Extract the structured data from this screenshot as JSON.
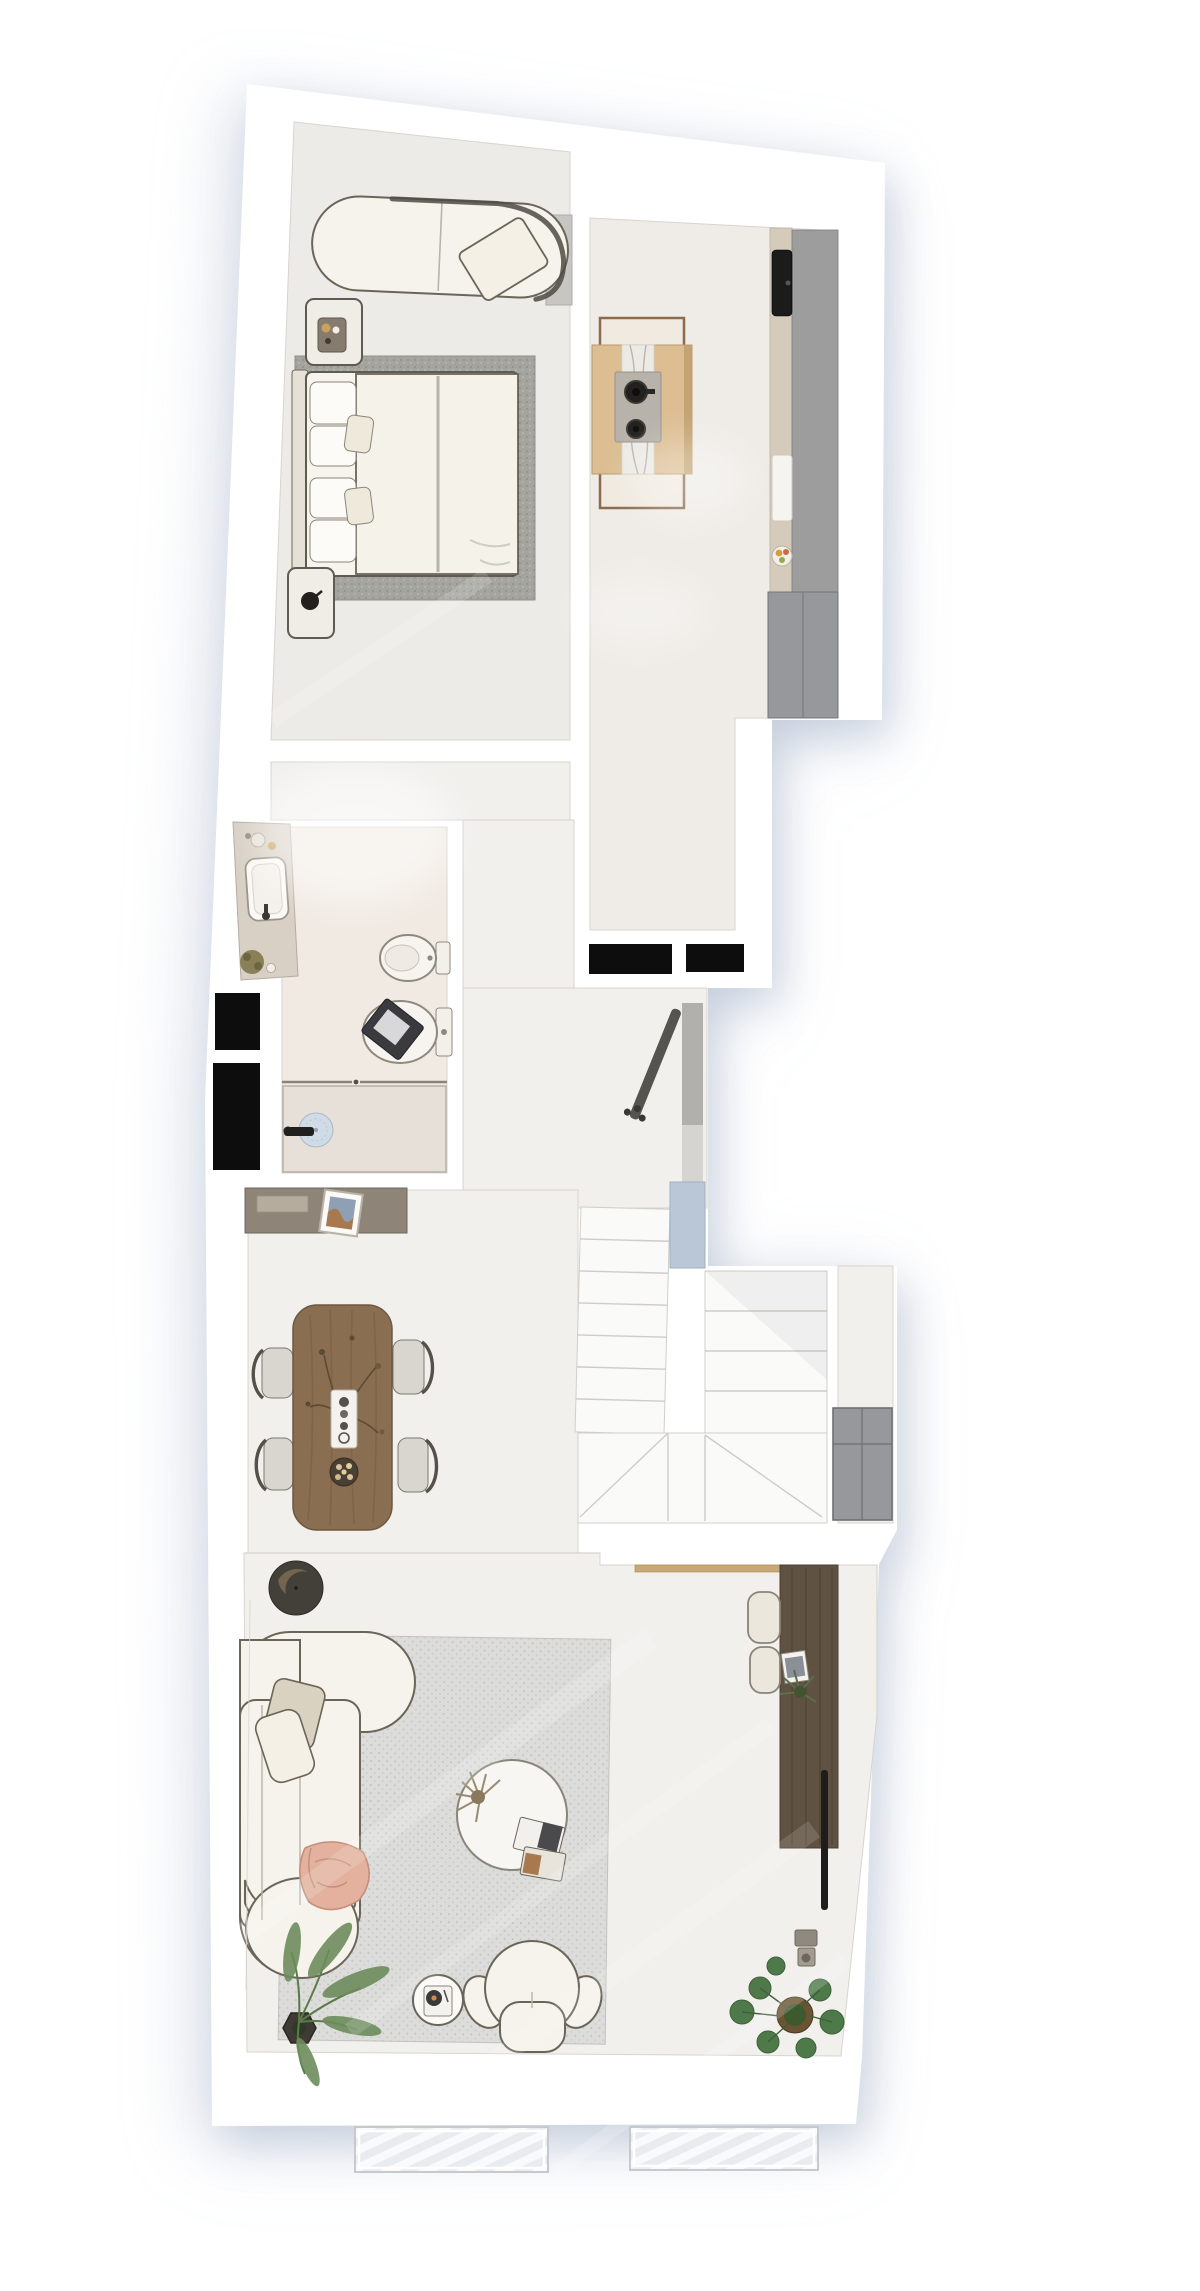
{
  "meta": {
    "view": "apartment floor plan, rendered top-down view",
    "visible_text": "none",
    "canvas": {
      "width": 1200,
      "height": 2291
    }
  },
  "palette": {
    "page_bg": "#ffffff",
    "wall": "#ffffff",
    "wall_line": "#d8d4cf",
    "floor_hall": "#f2f0ed",
    "floor_bedroom": "#edebe7",
    "floor_kitchen": "#efece7",
    "floor_bath": "#f1eae3",
    "rug_bedroom": "#a5a5a0",
    "rug_living": "#dcdcda",
    "sofa_fill": "#f6f3ec",
    "sofa_line": "#6b6458",
    "wood_dining": "#8a6e51",
    "wood_desk": "#5f5242",
    "wood_island": "#dcbe92",
    "wood_frame": "#8a6b4e",
    "wood_ledge": "#c9a877",
    "wood_console": "#8e8578",
    "counter_beige": "#d5cbbb",
    "counter_gray": "#9d9d9e",
    "cabinet_gray": "#96989b",
    "black": "#0d0d0d",
    "appliance_black": "#1b1b1b",
    "marble": "#eceae4",
    "glass_blue": "#bac7d7",
    "shower_tray": "#e7e0d9",
    "drain_blue": "#cfdce8",
    "plant_green": "#6d8c5c",
    "plant_dark": "#4e7a49",
    "plant_dried": "#9b8a6d",
    "pot_dark": "#43403a",
    "blanket_peach": "#e3b19d",
    "stair_tread": "#fafaf9",
    "stair_line": "#cfccc8",
    "grate_bg": "#e9ecef",
    "grate_stripe": "#f8fafb"
  },
  "rooms": {
    "bedroom": {
      "label": "Bedroom",
      "items": [
        "daybed-chaise",
        "throw-pillow",
        "wall-panel",
        "nightstand",
        "decor-tray",
        "double-bed",
        "bed-pillows",
        "duvet",
        "bedroom-rug",
        "nightstand-lamp"
      ]
    },
    "kitchen": {
      "label": "Kitchen",
      "items": [
        "island-frame-table",
        "kitchen-island",
        "marble-runner",
        "cooktop-two-burners",
        "counter-run",
        "black-sink",
        "cutting-board",
        "fruit-bowl",
        "tall-cabinet-unit"
      ]
    },
    "bathroom": {
      "label": "Bathroom",
      "items": [
        "vanity-counter",
        "basin",
        "faucet",
        "toiletries",
        "plant-basket",
        "bidet",
        "toilet",
        "toilet-tablet",
        "shower",
        "shower-glass",
        "shower-drain",
        "shower-mixer"
      ]
    },
    "hallway": {
      "label": "Hallway / Entry",
      "items": [
        "sideboard-console",
        "framed-artwork",
        "coat-rack",
        "glass-partition",
        "entrance-mat",
        "entrance-mat",
        "service-shaft",
        "service-shaft"
      ]
    },
    "staircase": {
      "label": "Staircase",
      "items": [
        "lower-flight",
        "upper-flight",
        "winder-treads",
        "stair-skylight-glass",
        "storage-cabinet"
      ]
    },
    "dining": {
      "label": "Dining area",
      "items": [
        "dining-table",
        "dining-chair",
        "dining-chair",
        "dining-chair",
        "dining-chair",
        "branch-centerpiece",
        "serving-tray",
        "pastry-plate",
        "floor-planter-bowl"
      ]
    },
    "living": {
      "label": "Living area",
      "items": [
        "corner-sofa",
        "cushions",
        "peach-throw",
        "living-rug",
        "round-coffee-table",
        "dried-plant-decor",
        "books",
        "record-player-table",
        "lounge-armchair",
        "palm-plant",
        "monstera-plant",
        "wall-desk",
        "desk-stool",
        "desk-stool",
        "desk-books",
        "desk-plant",
        "sliding-door-track",
        "door-hardware",
        "wall-ledge"
      ]
    },
    "exterior": {
      "label": "Exterior",
      "items": [
        "pavement-grate",
        "pavement-grate"
      ]
    }
  }
}
